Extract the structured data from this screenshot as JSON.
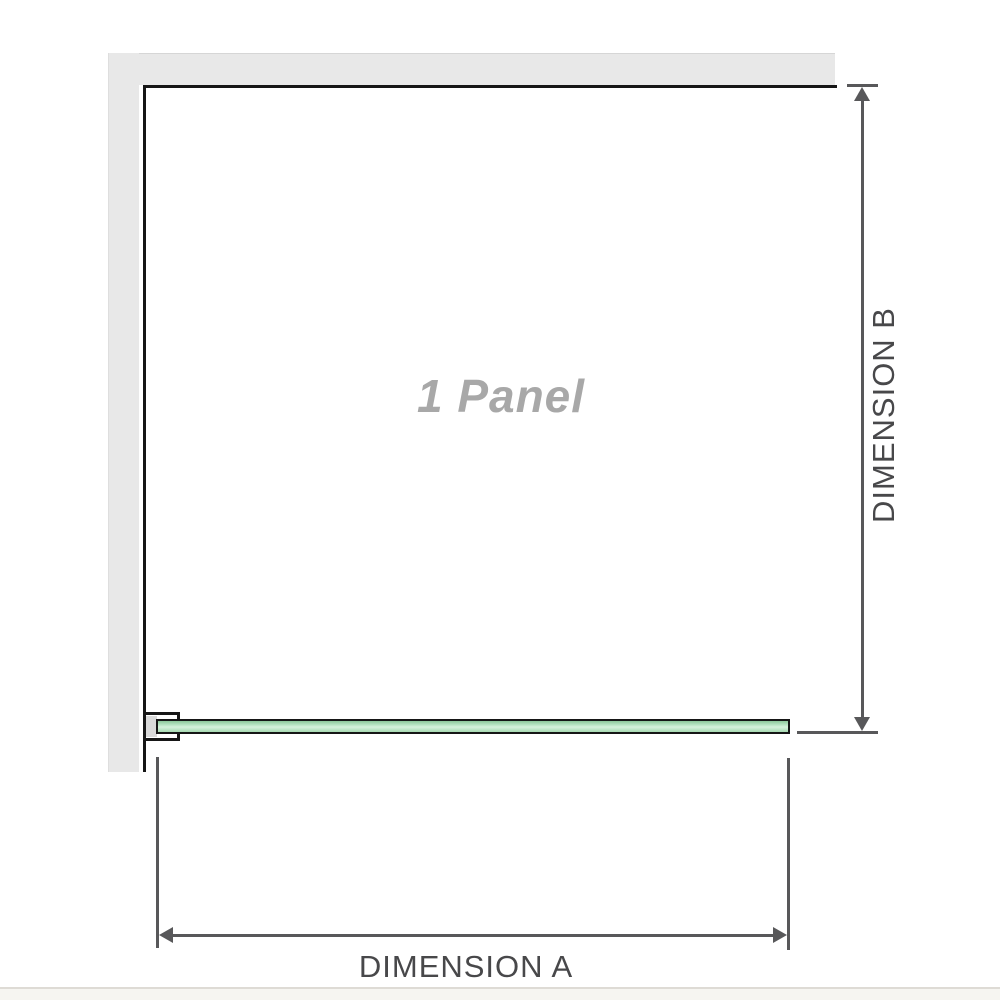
{
  "diagram": {
    "panel_label": "1 Panel",
    "dimension_a_label": "DIMENSION A",
    "dimension_b_label": "DIMENSION B"
  },
  "colors": {
    "wall_gray": "#e8e8e8",
    "outline_black": "#161616",
    "glass_green_top": "#8cc79a",
    "glass_green_light": "#d7f1dc",
    "glass_green_bottom": "#a6dab2",
    "dimension_gray": "#58585a",
    "label_gray": "#48484a",
    "panel_label_gray": "#a8a8a8",
    "bracket_pad_gray": "#d9d9d9",
    "divider_gray": "#dedbd5"
  }
}
